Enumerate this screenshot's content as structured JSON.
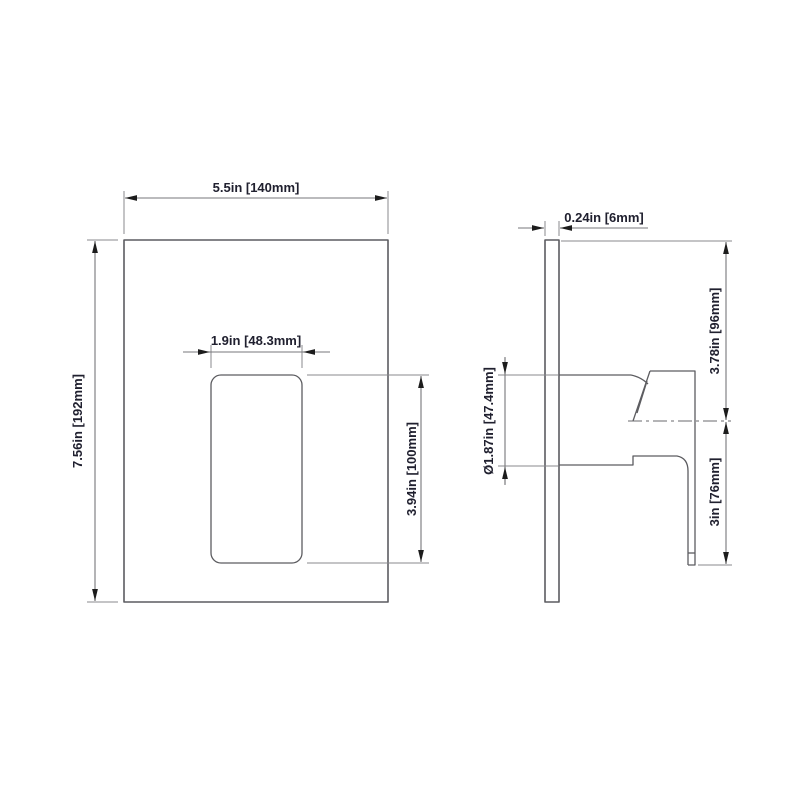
{
  "colors": {
    "background": "#ffffff",
    "object_line": "#5c5c60",
    "dimension_line": "#77777b",
    "extension_line": "#88888c",
    "arrow": "#1c1c1c",
    "text": "#20202f"
  },
  "front_view": {
    "dimensions": {
      "plate_width": "5.5in [140mm]",
      "plate_height": "7.56in [192mm]",
      "handle_width": "1.9in [48.3mm]",
      "handle_height": "3.94in [100mm]"
    }
  },
  "side_view": {
    "dimensions": {
      "plate_thickness": "0.24in [6mm]",
      "valve_diameter": "Ø1.87in [47.4mm]",
      "plate_top_to_handle_center": "3.78in [96mm]",
      "handle_center_to_bottom": "3in [76mm]"
    }
  }
}
